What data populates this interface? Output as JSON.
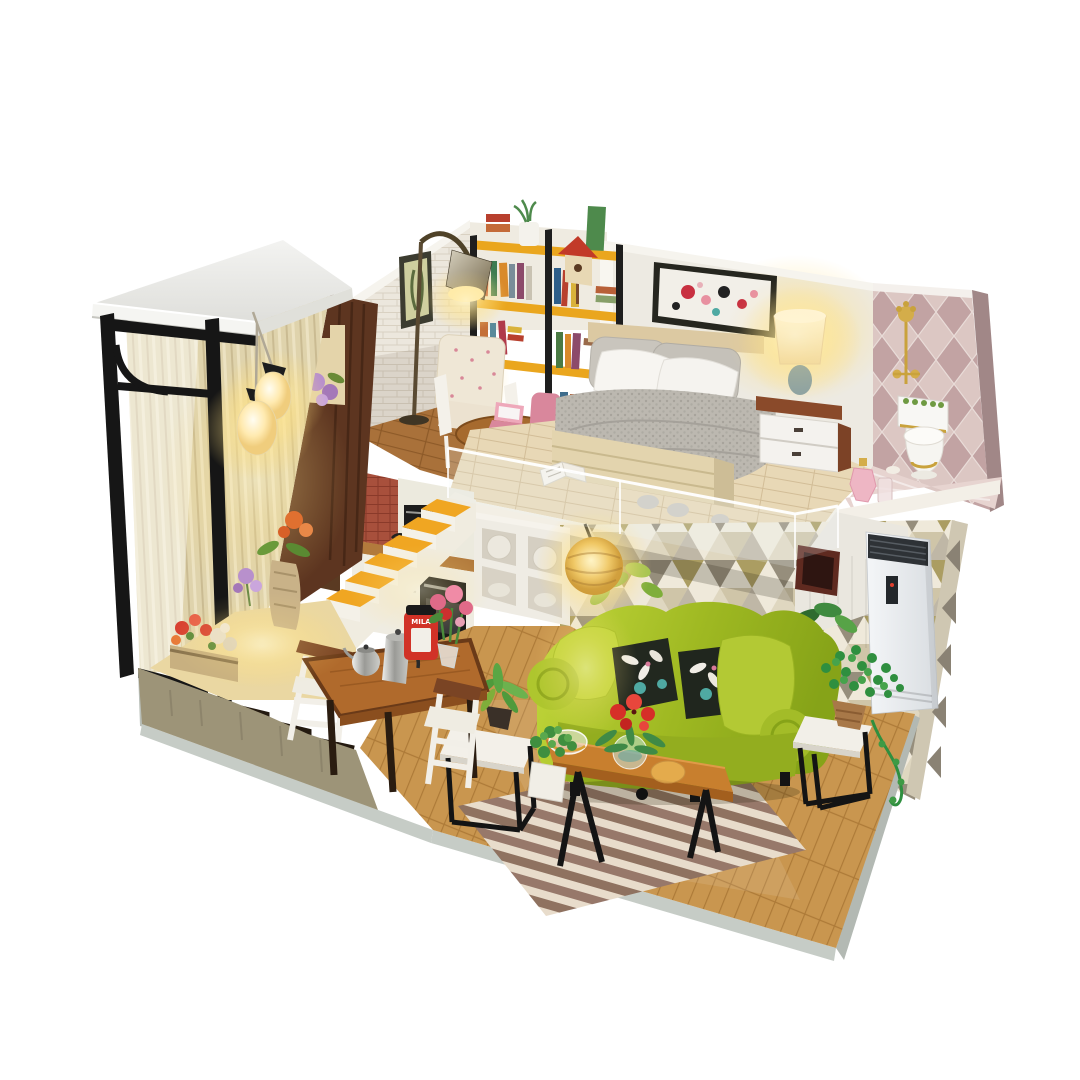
{
  "scene": {
    "type": "product-photograph",
    "subject": "DIY miniature dollhouse kit - two-story loft apartment diorama with lights on",
    "background_color": "#ffffff"
  },
  "labels": {
    "coffee_machine": "MILA"
  },
  "palette": {
    "roof_white": "#ececea",
    "frame_black": "#161616",
    "curtain_beige": "#dfd3ac",
    "dark_wood_wall": "#5d3520",
    "white_brick": "#ece7dd",
    "bedroom_wall": "#edeae2",
    "pink_harlequin_wall": "#dcc7c3",
    "triangle_wallpaper": "#efe9da",
    "loft_floor": "#e8d8b6",
    "ground_floor": "#c9964f",
    "stair_tread_yellow": "#f0a622",
    "sofa_green": "#9fb922",
    "bench_wood": "#c87f2e",
    "rug_stripe": "#8f7260",
    "lamp_glow": "#ffe9a8",
    "gold_fixture": "#c9a23c",
    "mila_red": "#d13227"
  },
  "rooms": {
    "upper_floor": {
      "study": [
        "floor-lamp",
        "bookshelf with books",
        "birdhouse ornament",
        "white vase plant",
        "framed picture",
        "floral armchair",
        "round desk",
        "pink laptop",
        "pink chair"
      ],
      "bedroom": [
        "abstract painting",
        "double bed",
        "grey knit blanket",
        "satin pillows",
        "nightstand",
        "glowing table lamp"
      ],
      "bathroom": [
        "gold shower set",
        "toilet with gold trim",
        "perfume bottles",
        "pink marble floor"
      ]
    },
    "lower_floor": {
      "living_room": [
        "crinkle pendant lamp",
        "green sofa",
        "black floral pillows",
        "coffee bench",
        "red flowers",
        "glass bowls",
        "striped rug",
        "side tables",
        "potted plants",
        "standing air conditioner"
      ],
      "dining_area": [
        "wood dining table",
        "white chairs",
        "silver kettle",
        "silver coffee pot",
        "MILA coffee machine",
        "pink flowers"
      ],
      "kitchen": [
        "red tile backsplash",
        "counter",
        "black oven",
        "cube shelving with plates",
        "yellow staircase"
      ],
      "balcony_display": [
        "black metal frame",
        "beige curtain",
        "pendant lamps",
        "planter boxes",
        "carved vase with lily"
      ]
    }
  }
}
